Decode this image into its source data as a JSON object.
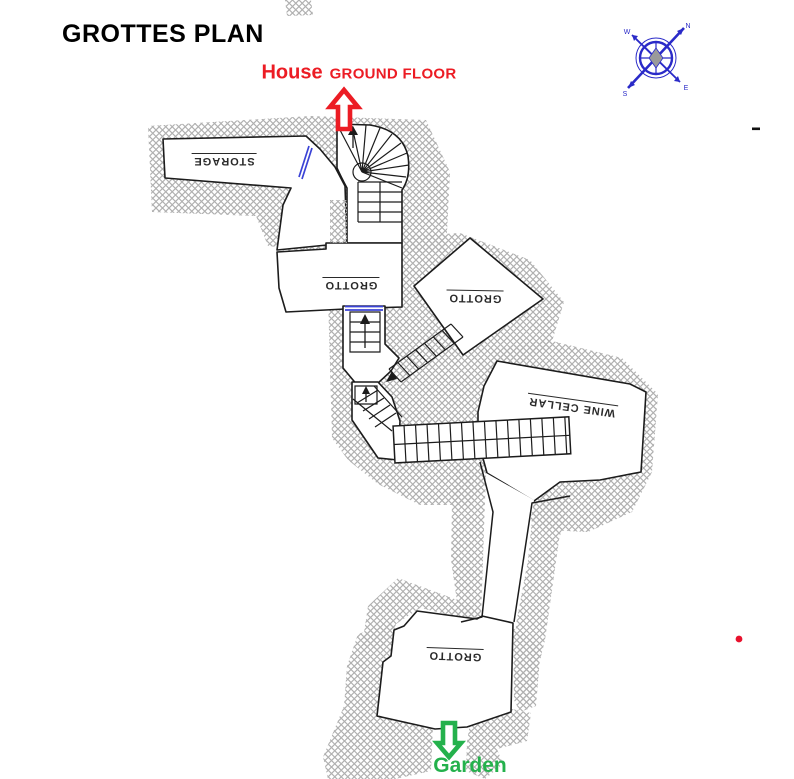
{
  "title": "GROTTES PLAN",
  "annotations": {
    "house": "House",
    "house_floor": "GROUND FLOOR",
    "garden": "Garden"
  },
  "rooms": [
    {
      "label": "STORAGE"
    },
    {
      "label": "GROTTO"
    },
    {
      "label": "GROTTO"
    },
    {
      "label": "WINE CELLAR"
    },
    {
      "label": "GROTTO"
    }
  ],
  "compass": {
    "n": "N",
    "e": "E",
    "s": "S",
    "w": "W"
  },
  "icons": {
    "house_arrow": "up-block-arrow",
    "garden_arrow": "down-block-arrow",
    "compass": "compass-rose",
    "stair_direction": "up-arrow"
  },
  "colors": {
    "wall": "#1c1c1c",
    "hatch": "#b0b0b0",
    "door_blue": "#3b43d6",
    "arrow_red": "#ec1c24",
    "arrow_green": "#24b14c",
    "compass_blue": "#2a2ac8",
    "dot_red": "#e8112d"
  }
}
